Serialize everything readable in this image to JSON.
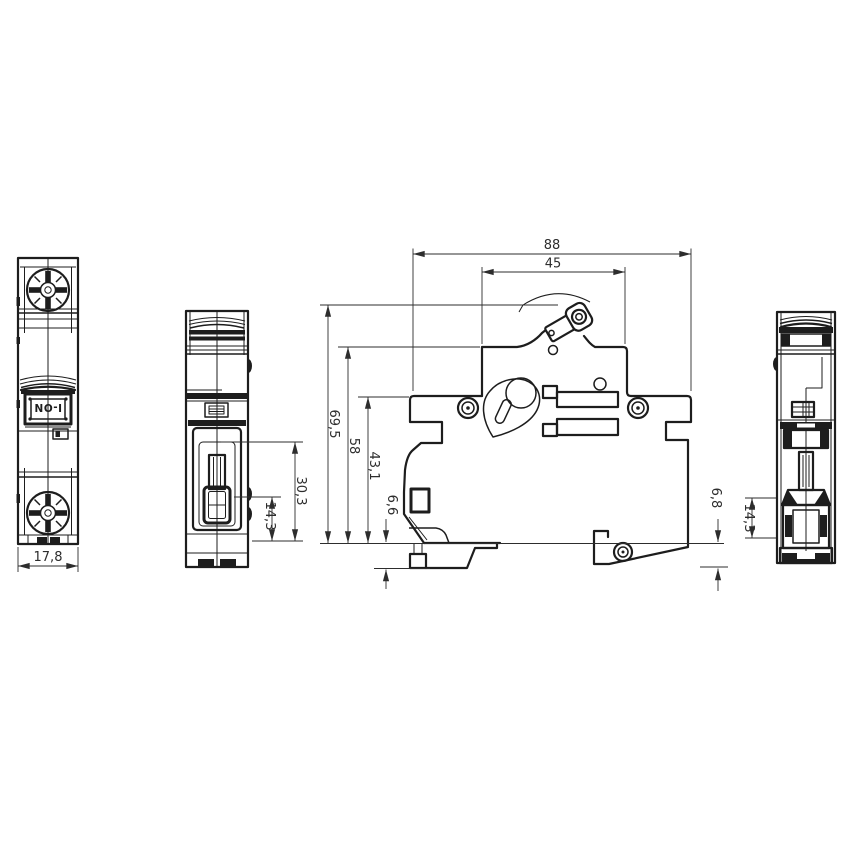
{
  "colors": {
    "background": "#ffffff",
    "line": "#1d1d1d",
    "dim": "#2d2d2d"
  },
  "front_view": {
    "toggle_label": "I-ON",
    "dim_module_width": "17,8"
  },
  "side_view_small": {
    "dim_toggle_travel": "30,3",
    "dim_toggle_protrusion": "14,3"
  },
  "main_view": {
    "dim_overall_width": "88",
    "dim_pole_width": "45",
    "dim_height_total": "69,5",
    "dim_height_body": "58",
    "dim_height_lower": "43,1",
    "dim_clip_below_left": "6,6",
    "dim_clip_below_right": "6,8"
  },
  "rear_view": {
    "dim_toggle_protrusion": "14,3"
  }
}
